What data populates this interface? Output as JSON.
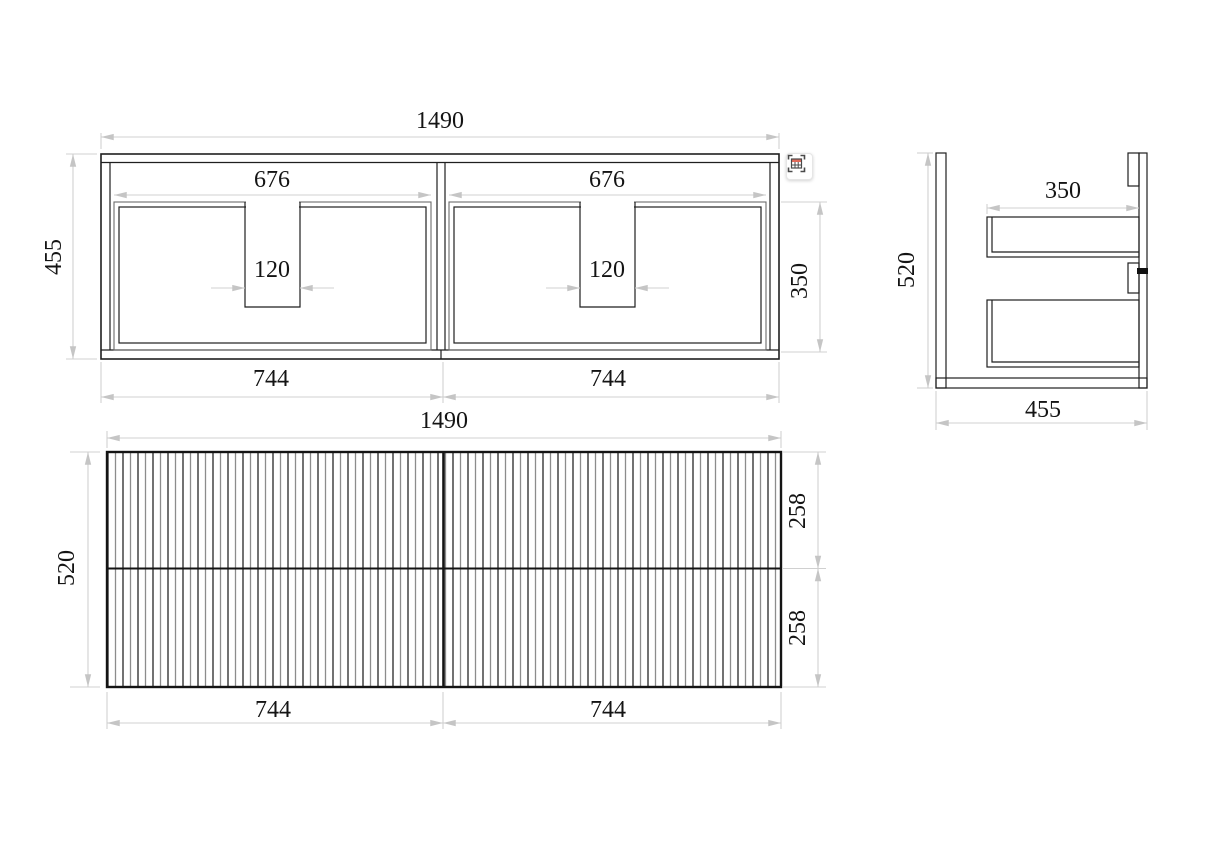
{
  "drawing": {
    "plan": {
      "width_total": "1490",
      "depth": "455",
      "opening_left": "676",
      "opening_right": "676",
      "notch_left": "120",
      "notch_right": "120",
      "opening_depth": "350",
      "half_left": "744",
      "half_right": "744"
    },
    "side": {
      "height": "520",
      "drawer_depth": "350",
      "depth_total": "455"
    },
    "front": {
      "width_total": "1490",
      "height": "520",
      "drawer_upper": "258",
      "drawer_lower": "258",
      "half_left": "744",
      "half_right": "744"
    }
  },
  "colors": {
    "background": "#ffffff",
    "line": "#1f1f1f",
    "dimension": "#d0d0d0",
    "icon_red": "#e06a5a"
  },
  "toolbar": {
    "capture_icon": "table-capture"
  }
}
